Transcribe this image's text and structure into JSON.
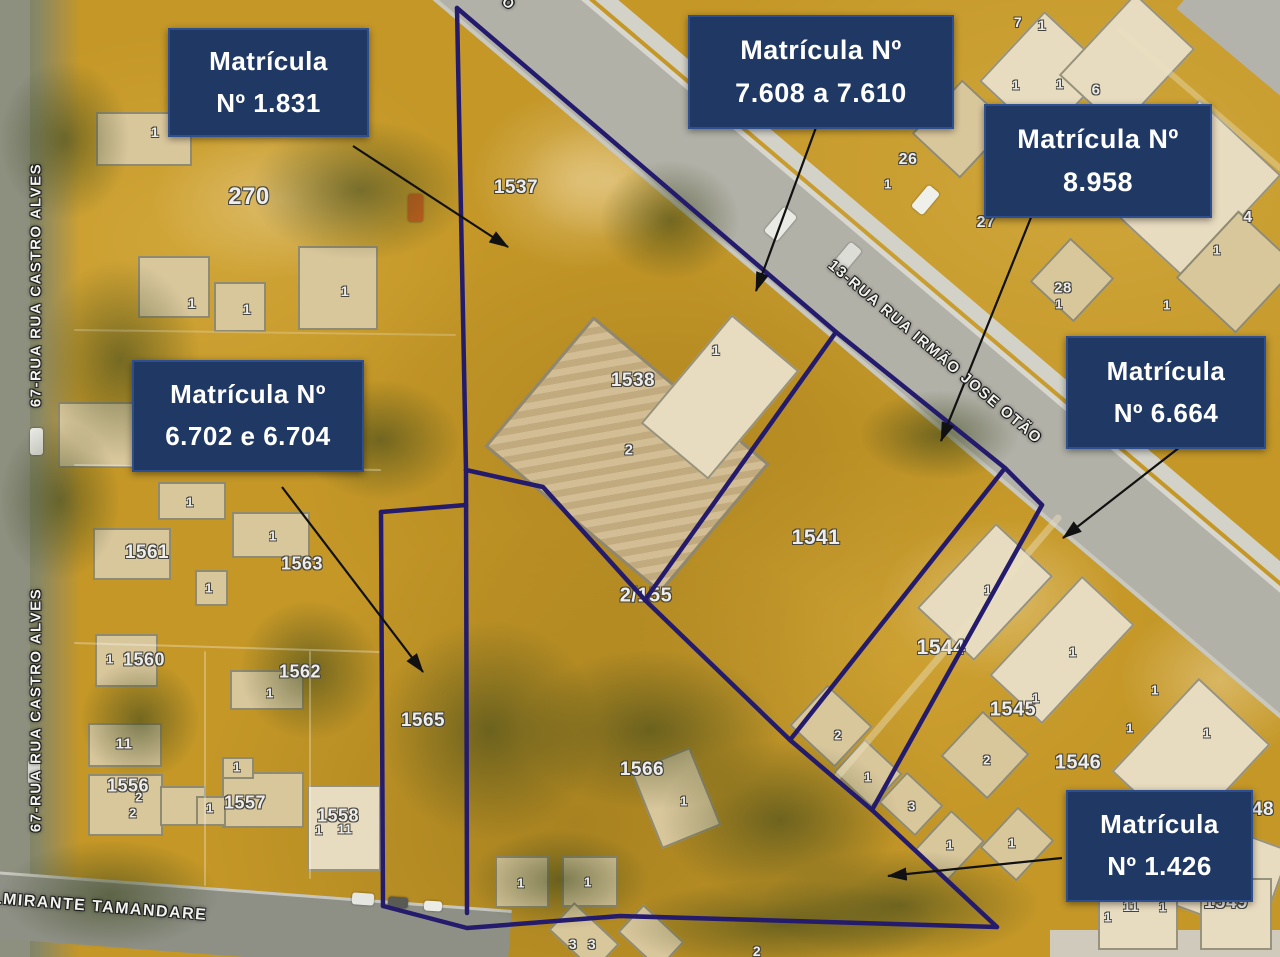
{
  "matricula_labels": [
    {
      "line1": "Matrícula",
      "line2": "Nº 1.831"
    },
    {
      "line1": "Matrícula Nº",
      "line2": "7.608 a 7.610"
    },
    {
      "line1": "Matrícula Nº",
      "line2": "8.958"
    },
    {
      "line1": "Matrícula",
      "line2": "Nº 6.664"
    },
    {
      "line1": "Matrícula Nº",
      "line2": "6.702 e 6.704"
    },
    {
      "line1": "Matrícula",
      "line2": "Nº 1.426"
    }
  ],
  "streets": {
    "left_vertical": "67-RUA RUA CASTRO ALVES",
    "left_vertical_2": "67-RUA RUA CASTRO ALVES",
    "diagonal": "13-RUA RUA IRMÃO JOSE OTÃO",
    "bottom": "ALMIRANTE TAMANDARE",
    "top_fragment": "O"
  },
  "colors": {
    "label_box": "#1f3864",
    "label_text": "#ffffff",
    "boundary": "#241b6d",
    "arrow": "#111111",
    "base_terrain": "#c49727"
  },
  "map": {
    "lots": [
      [
        "270",
        249,
        197,
        24
      ],
      [
        "1",
        155,
        132,
        14
      ],
      [
        "1",
        192,
        303,
        14
      ],
      [
        "1",
        247,
        309,
        14
      ],
      [
        "1",
        345,
        291,
        14
      ],
      [
        "1537",
        516,
        188,
        19
      ],
      [
        "1538",
        633,
        381,
        19
      ],
      [
        "1",
        716,
        350,
        14
      ],
      [
        "2",
        629,
        450,
        15
      ],
      [
        "2/155",
        646,
        596,
        20
      ],
      [
        "1541",
        816,
        538,
        21
      ],
      [
        "1544",
        941,
        648,
        21
      ],
      [
        "1545",
        1013,
        710,
        20
      ],
      [
        "1",
        1036,
        698,
        13
      ],
      [
        "1546",
        1078,
        763,
        20
      ],
      [
        "48",
        1263,
        810,
        19
      ],
      [
        "1549",
        1226,
        903,
        19
      ],
      [
        "26",
        908,
        160,
        16
      ],
      [
        "1",
        888,
        184,
        13
      ],
      [
        "27",
        986,
        223,
        16
      ],
      [
        "28",
        1063,
        288,
        15
      ],
      [
        "1",
        1059,
        304,
        13
      ],
      [
        "7",
        1018,
        22,
        14
      ],
      [
        "1",
        1042,
        25,
        14
      ],
      [
        "1",
        1016,
        85,
        13
      ],
      [
        "1",
        1060,
        84,
        13
      ],
      [
        "6",
        1096,
        90,
        15
      ],
      [
        "4",
        1248,
        218,
        16
      ],
      [
        "1",
        1217,
        250,
        13
      ],
      [
        "1",
        1167,
        305,
        13
      ],
      [
        "1561",
        147,
        553,
        19
      ],
      [
        "1",
        190,
        502,
        13
      ],
      [
        "1",
        273,
        536,
        13
      ],
      [
        "1563",
        302,
        564,
        18
      ],
      [
        "1",
        209,
        588,
        13
      ],
      [
        "1",
        110,
        659,
        13
      ],
      [
        "1560",
        144,
        660,
        18
      ],
      [
        "1562",
        300,
        672,
        18
      ],
      [
        "1",
        270,
        693,
        13
      ],
      [
        "1565",
        423,
        721,
        19
      ],
      [
        "1566",
        642,
        770,
        19
      ],
      [
        "1",
        684,
        801,
        13
      ],
      [
        "1",
        521,
        883,
        13
      ],
      [
        "1",
        588,
        882,
        13
      ],
      [
        "3",
        573,
        944,
        14
      ],
      [
        "3",
        592,
        944,
        14
      ],
      [
        "2",
        757,
        951,
        14
      ],
      [
        "11",
        124,
        744,
        15
      ],
      [
        "1556",
        128,
        786,
        18
      ],
      [
        "2",
        139,
        797,
        13
      ],
      [
        "2",
        133,
        813,
        13
      ],
      [
        "1",
        237,
        767,
        13
      ],
      [
        "1557",
        245,
        803,
        18
      ],
      [
        "1",
        210,
        808,
        13
      ],
      [
        "1558",
        338,
        816,
        18
      ],
      [
        "1",
        319,
        830,
        13
      ],
      [
        "11",
        345,
        829,
        13
      ],
      [
        "1",
        950,
        845,
        13
      ],
      [
        "1",
        1012,
        843,
        13
      ],
      [
        "1",
        988,
        590,
        13
      ],
      [
        "2",
        838,
        735,
        13
      ],
      [
        "1",
        868,
        777,
        13
      ],
      [
        "3",
        912,
        806,
        13
      ],
      [
        "2",
        987,
        760,
        13
      ],
      [
        "1",
        1073,
        652,
        13
      ],
      [
        "1",
        1130,
        728,
        13
      ],
      [
        "1",
        1155,
        690,
        13
      ],
      [
        "1",
        1207,
        733,
        13
      ],
      [
        "11",
        1131,
        906,
        14
      ],
      [
        "1",
        1163,
        907,
        13
      ],
      [
        "1",
        1108,
        917,
        13
      ]
    ],
    "buildings": [
      [
        96,
        112,
        96,
        54,
        0,
        0
      ],
      [
        138,
        256,
        72,
        62,
        0,
        0
      ],
      [
        214,
        282,
        52,
        50,
        0,
        0
      ],
      [
        298,
        246,
        80,
        84,
        0,
        0
      ],
      [
        58,
        402,
        96,
        66,
        0,
        0
      ],
      [
        93,
        528,
        78,
        52,
        0,
        0
      ],
      [
        158,
        482,
        68,
        38,
        0,
        0
      ],
      [
        232,
        512,
        78,
        46,
        0,
        0
      ],
      [
        195,
        570,
        33,
        36,
        0,
        0
      ],
      [
        95,
        634,
        63,
        53,
        0,
        0
      ],
      [
        230,
        670,
        74,
        40,
        0,
        0
      ],
      [
        88,
        723,
        74,
        44,
        0,
        0
      ],
      [
        88,
        774,
        75,
        62,
        0,
        0
      ],
      [
        160,
        786,
        46,
        40,
        0,
        0
      ],
      [
        222,
        772,
        82,
        56,
        0,
        0
      ],
      [
        196,
        796,
        30,
        30,
        0,
        0
      ],
      [
        222,
        757,
        32,
        22,
        0,
        0
      ],
      [
        307,
        785,
        74,
        86,
        0,
        1
      ],
      [
        495,
        856,
        54,
        52,
        0,
        0
      ],
      [
        562,
        856,
        56,
        51,
        0,
        0
      ],
      [
        553,
        918,
        62,
        38,
        43,
        0
      ],
      [
        623,
        918,
        56,
        38,
        43,
        0
      ],
      [
        644,
        756,
        64,
        84,
        -22,
        0
      ],
      [
        512,
        370,
        230,
        170,
        40,
        2
      ],
      [
        676,
        326,
        88,
        142,
        40,
        1
      ],
      [
        800,
        698,
        62,
        56,
        43,
        0
      ],
      [
        842,
        750,
        52,
        46,
        43,
        0
      ],
      [
        886,
        783,
        50,
        42,
        43,
        0
      ],
      [
        946,
        534,
        78,
        116,
        43,
        1
      ],
      [
        1026,
        582,
        72,
        136,
        43,
        1
      ],
      [
        953,
        724,
        64,
        62,
        43,
        0
      ],
      [
        926,
        818,
        46,
        56,
        43,
        0
      ],
      [
        992,
        816,
        50,
        56,
        43,
        0
      ],
      [
        1000,
        28,
        88,
        96,
        43,
        1
      ],
      [
        1086,
        6,
        82,
        112,
        43,
        1
      ],
      [
        928,
        92,
        66,
        74,
        43,
        0
      ],
      [
        1136,
        118,
        112,
        142,
        43,
        1
      ],
      [
        1196,
        226,
        82,
        92,
        43,
        0
      ],
      [
        1042,
        250,
        60,
        60,
        43,
        0
      ],
      [
        1142,
        694,
        98,
        128,
        43,
        1
      ],
      [
        1186,
        832,
        92,
        92,
        20,
        1
      ],
      [
        1098,
        884,
        80,
        66,
        0,
        1
      ],
      [
        1200,
        878,
        72,
        72,
        0,
        1
      ]
    ],
    "vehicles": [
      [
        408,
        194,
        15,
        28,
        0,
        "#c95f1d"
      ],
      [
        772,
        208,
        17,
        32,
        40,
        "#e9eae4"
      ],
      [
        840,
        243,
        15,
        28,
        40,
        "#dcddd6"
      ],
      [
        918,
        186,
        15,
        28,
        40,
        "#f0f0ea"
      ],
      [
        30,
        428,
        13,
        27,
        0,
        "#e8e8e4"
      ],
      [
        28,
        760,
        12,
        24,
        0,
        "#d8d8d2"
      ],
      [
        352,
        893,
        22,
        12,
        4,
        "#e6e6e0"
      ],
      [
        388,
        897,
        20,
        11,
        4,
        "#5a5a55"
      ],
      [
        424,
        901,
        18,
        10,
        4,
        "#ecece6"
      ]
    ],
    "trees": [
      [
        250,
        120,
        220,
        140
      ],
      [
        40,
        260,
        160,
        200
      ],
      [
        0,
        420,
        120,
        160
      ],
      [
        300,
        380,
        160,
        120
      ],
      [
        380,
        620,
        220,
        220
      ],
      [
        520,
        650,
        260,
        160
      ],
      [
        600,
        160,
        140,
        120
      ],
      [
        860,
        390,
        160,
        90
      ],
      [
        470,
        830,
        180,
        100
      ],
      [
        240,
        600,
        140,
        140
      ],
      [
        0,
        60,
        130,
        160
      ],
      [
        660,
        740,
        240,
        160
      ],
      [
        760,
        850,
        280,
        110
      ],
      [
        0,
        840,
        220,
        110
      ],
      [
        80,
        660,
        120,
        120
      ],
      [
        620,
        880,
        320,
        90
      ]
    ],
    "patches": [
      [
        470,
        90,
        220,
        180
      ],
      [
        150,
        120,
        260,
        160
      ],
      [
        880,
        520,
        240,
        160
      ],
      [
        1120,
        600,
        200,
        160
      ],
      [
        520,
        120,
        180,
        120
      ]
    ],
    "boundaries": [
      [
        [
          457,
          8
        ],
        [
          466,
          470
        ]
      ],
      [
        [
          457,
          8
        ],
        [
          836,
          332
        ],
        [
          1005,
          468
        ],
        [
          1042,
          505
        ]
      ],
      [
        [
          466,
          470
        ],
        [
          543,
          487
        ],
        [
          645,
          600
        ],
        [
          790,
          740
        ],
        [
          872,
          810
        ],
        [
          997,
          927
        ]
      ],
      [
        [
          836,
          332
        ],
        [
          645,
          600
        ]
      ],
      [
        [
          1005,
          468
        ],
        [
          790,
          740
        ]
      ],
      [
        [
          1042,
          505
        ],
        [
          872,
          810
        ]
      ],
      [
        [
          381,
          512
        ],
        [
          383,
          906
        ]
      ],
      [
        [
          381,
          512
        ],
        [
          466,
          505
        ]
      ],
      [
        [
          466,
          470
        ],
        [
          467,
          913
        ]
      ],
      [
        [
          383,
          906
        ],
        [
          467,
          928
        ],
        [
          620,
          916
        ],
        [
          997,
          927
        ]
      ]
    ],
    "parcel_faint": [
      [
        [
          [
            75,
            465
          ],
          [
            380,
            470
          ]
        ],
        2,
        "rgba(255,255,255,.30)"
      ],
      [
        [
          [
            75,
            643
          ],
          [
            380,
            652
          ]
        ],
        2,
        "rgba(255,255,255,.30)"
      ],
      [
        [
          [
            205,
            652
          ],
          [
            205,
            885
          ]
        ],
        2,
        "rgba(255,255,255,.28)"
      ],
      [
        [
          [
            310,
            652
          ],
          [
            310,
            878
          ]
        ],
        2,
        "rgba(255,255,255,.28)"
      ],
      [
        [
          [
            75,
            330
          ],
          [
            455,
            335
          ]
        ],
        2,
        "rgba(255,255,255,.22)"
      ],
      [
        [
          [
            838,
            776
          ],
          [
            1058,
            518
          ]
        ],
        7,
        "rgba(235,225,190,.45)"
      ],
      [
        [
          [
            1120,
            30
          ],
          [
            1280,
            168
          ]
        ],
        6,
        "rgba(235,225,190,.40)"
      ]
    ],
    "arrows": [
      [
        353,
        146,
        508,
        247
      ],
      [
        818,
        122,
        756,
        291
      ],
      [
        1032,
        215,
        941,
        441
      ],
      [
        1180,
        447,
        1063,
        538
      ],
      [
        282,
        487,
        423,
        672
      ],
      [
        1062,
        858,
        888,
        876
      ]
    ]
  }
}
